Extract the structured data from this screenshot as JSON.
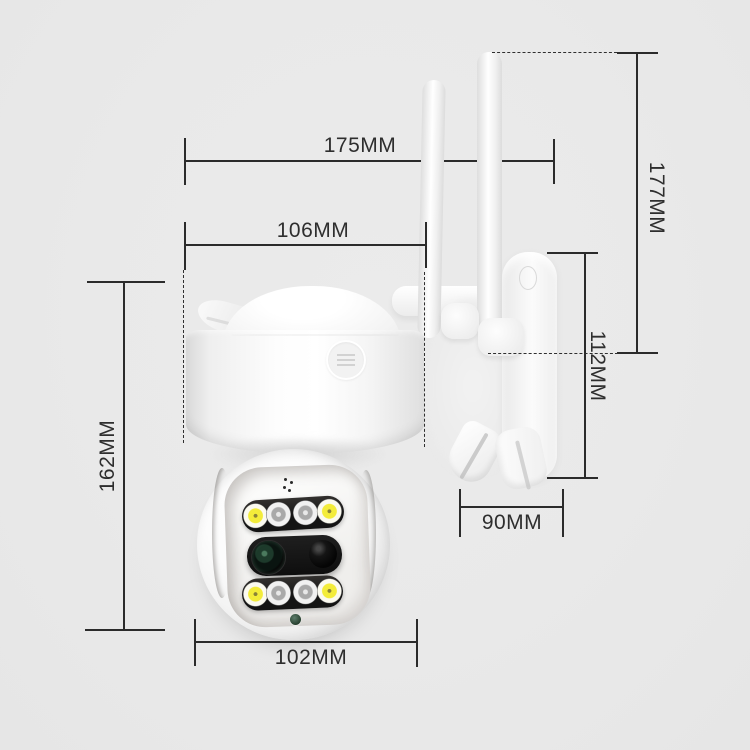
{
  "scene": {
    "background_color": "#e9e9e9",
    "annotation_line_color": "#2b2b2b",
    "label_text_color": "#2e2e2e"
  },
  "product": {
    "name": "white dual-lens PTZ wifi security camera with wall bracket",
    "colors": {
      "body_white": "#fafafa",
      "led_bar_black": "#141414",
      "warm_led_yellow": "#f3ec3a",
      "wide_lens_green": "#1d3a2b",
      "status_dot_green": "#3c5c4a"
    }
  },
  "dimensions": {
    "overall_width": {
      "label": "175MM"
    },
    "body_width": {
      "label": "106MM"
    },
    "body_height": {
      "label": "162MM"
    },
    "overall_height": {
      "label": "177MM"
    },
    "bracket_height": {
      "label": "112MM"
    },
    "bracket_depth": {
      "label": "90MM"
    },
    "head_width": {
      "label": "102MM"
    }
  }
}
